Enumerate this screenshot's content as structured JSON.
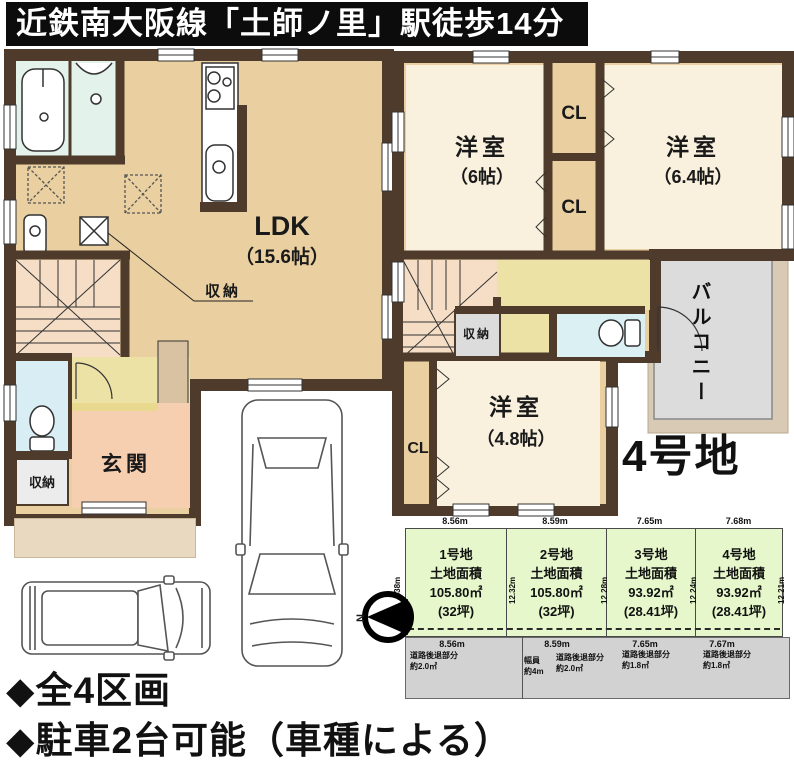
{
  "title": "近鉄南大阪線「土師ノ里」駅徒歩14分",
  "floor1": {
    "ldk": {
      "name": "LDK",
      "size": "（15.6帖）"
    },
    "storage": "収納",
    "entrance": "玄関",
    "entrance_storage": "収納"
  },
  "floor2": {
    "room_top_left": {
      "name": "洋室",
      "size": "（6帖）"
    },
    "room_top_right": {
      "name": "洋室",
      "size": "（6.4帖）"
    },
    "room_bottom": {
      "name": "洋室",
      "size": "（4.8帖）"
    },
    "closet_label": "CL",
    "storage": "収納",
    "balcony": "バルコニー",
    "lot_tag": "4号地"
  },
  "site_plan": {
    "north_label": "N",
    "left_edge": "12.38m",
    "road": {
      "width_label": "幅員",
      "width_value": "約4m"
    },
    "lots": [
      {
        "name": "1号地",
        "area_title": "土地面積",
        "area": "105.80㎡",
        "tsubo": "(32坪)",
        "front": "8.56m",
        "front_road": "8.56m",
        "side": "12.32m",
        "setback_label": "道路後退部分",
        "setback": "約2.0㎡"
      },
      {
        "name": "2号地",
        "area_title": "土地面積",
        "area": "105.80㎡",
        "tsubo": "(32坪)",
        "front": "8.59m",
        "front_road": "8.59m",
        "side": "12.28m",
        "setback_label": "道路後退部分",
        "setback": "約2.0㎡"
      },
      {
        "name": "3号地",
        "area_title": "土地面積",
        "area": "93.92㎡",
        "tsubo": "(28.41坪)",
        "front": "7.65m",
        "front_road": "7.65m",
        "side": "12.24m",
        "setback_label": "道路後退部分",
        "setback": "約1.8㎡"
      },
      {
        "name": "4号地",
        "area_title": "土地面積",
        "area": "93.92㎡",
        "tsubo": "(28.41坪)",
        "front": "7.68m",
        "front_road": "7.67m",
        "side": "12.21m",
        "setback_label": "道路後退部分",
        "setback": "約1.8㎡"
      }
    ]
  },
  "footer": {
    "line1": "◆全4区画",
    "line2": "◆駐車2台可能（車種による）"
  },
  "colors": {
    "wall": "#4e3b2b",
    "floor_tan": "#eacfa0",
    "room_cream": "#f9f1dd",
    "hall_yellow": "#ece2a6",
    "entrance_pink": "#f6cfb1",
    "stairs_peach": "#f5dec5",
    "bath_cyan": "#e4f2ec",
    "toilet_blue": "#d8edf4",
    "balcony_gray": "#dcdcdc",
    "lot_green": "#e6f8cb",
    "road_gray": "#d2d2d2",
    "banner_black": "#0c0c0c"
  }
}
